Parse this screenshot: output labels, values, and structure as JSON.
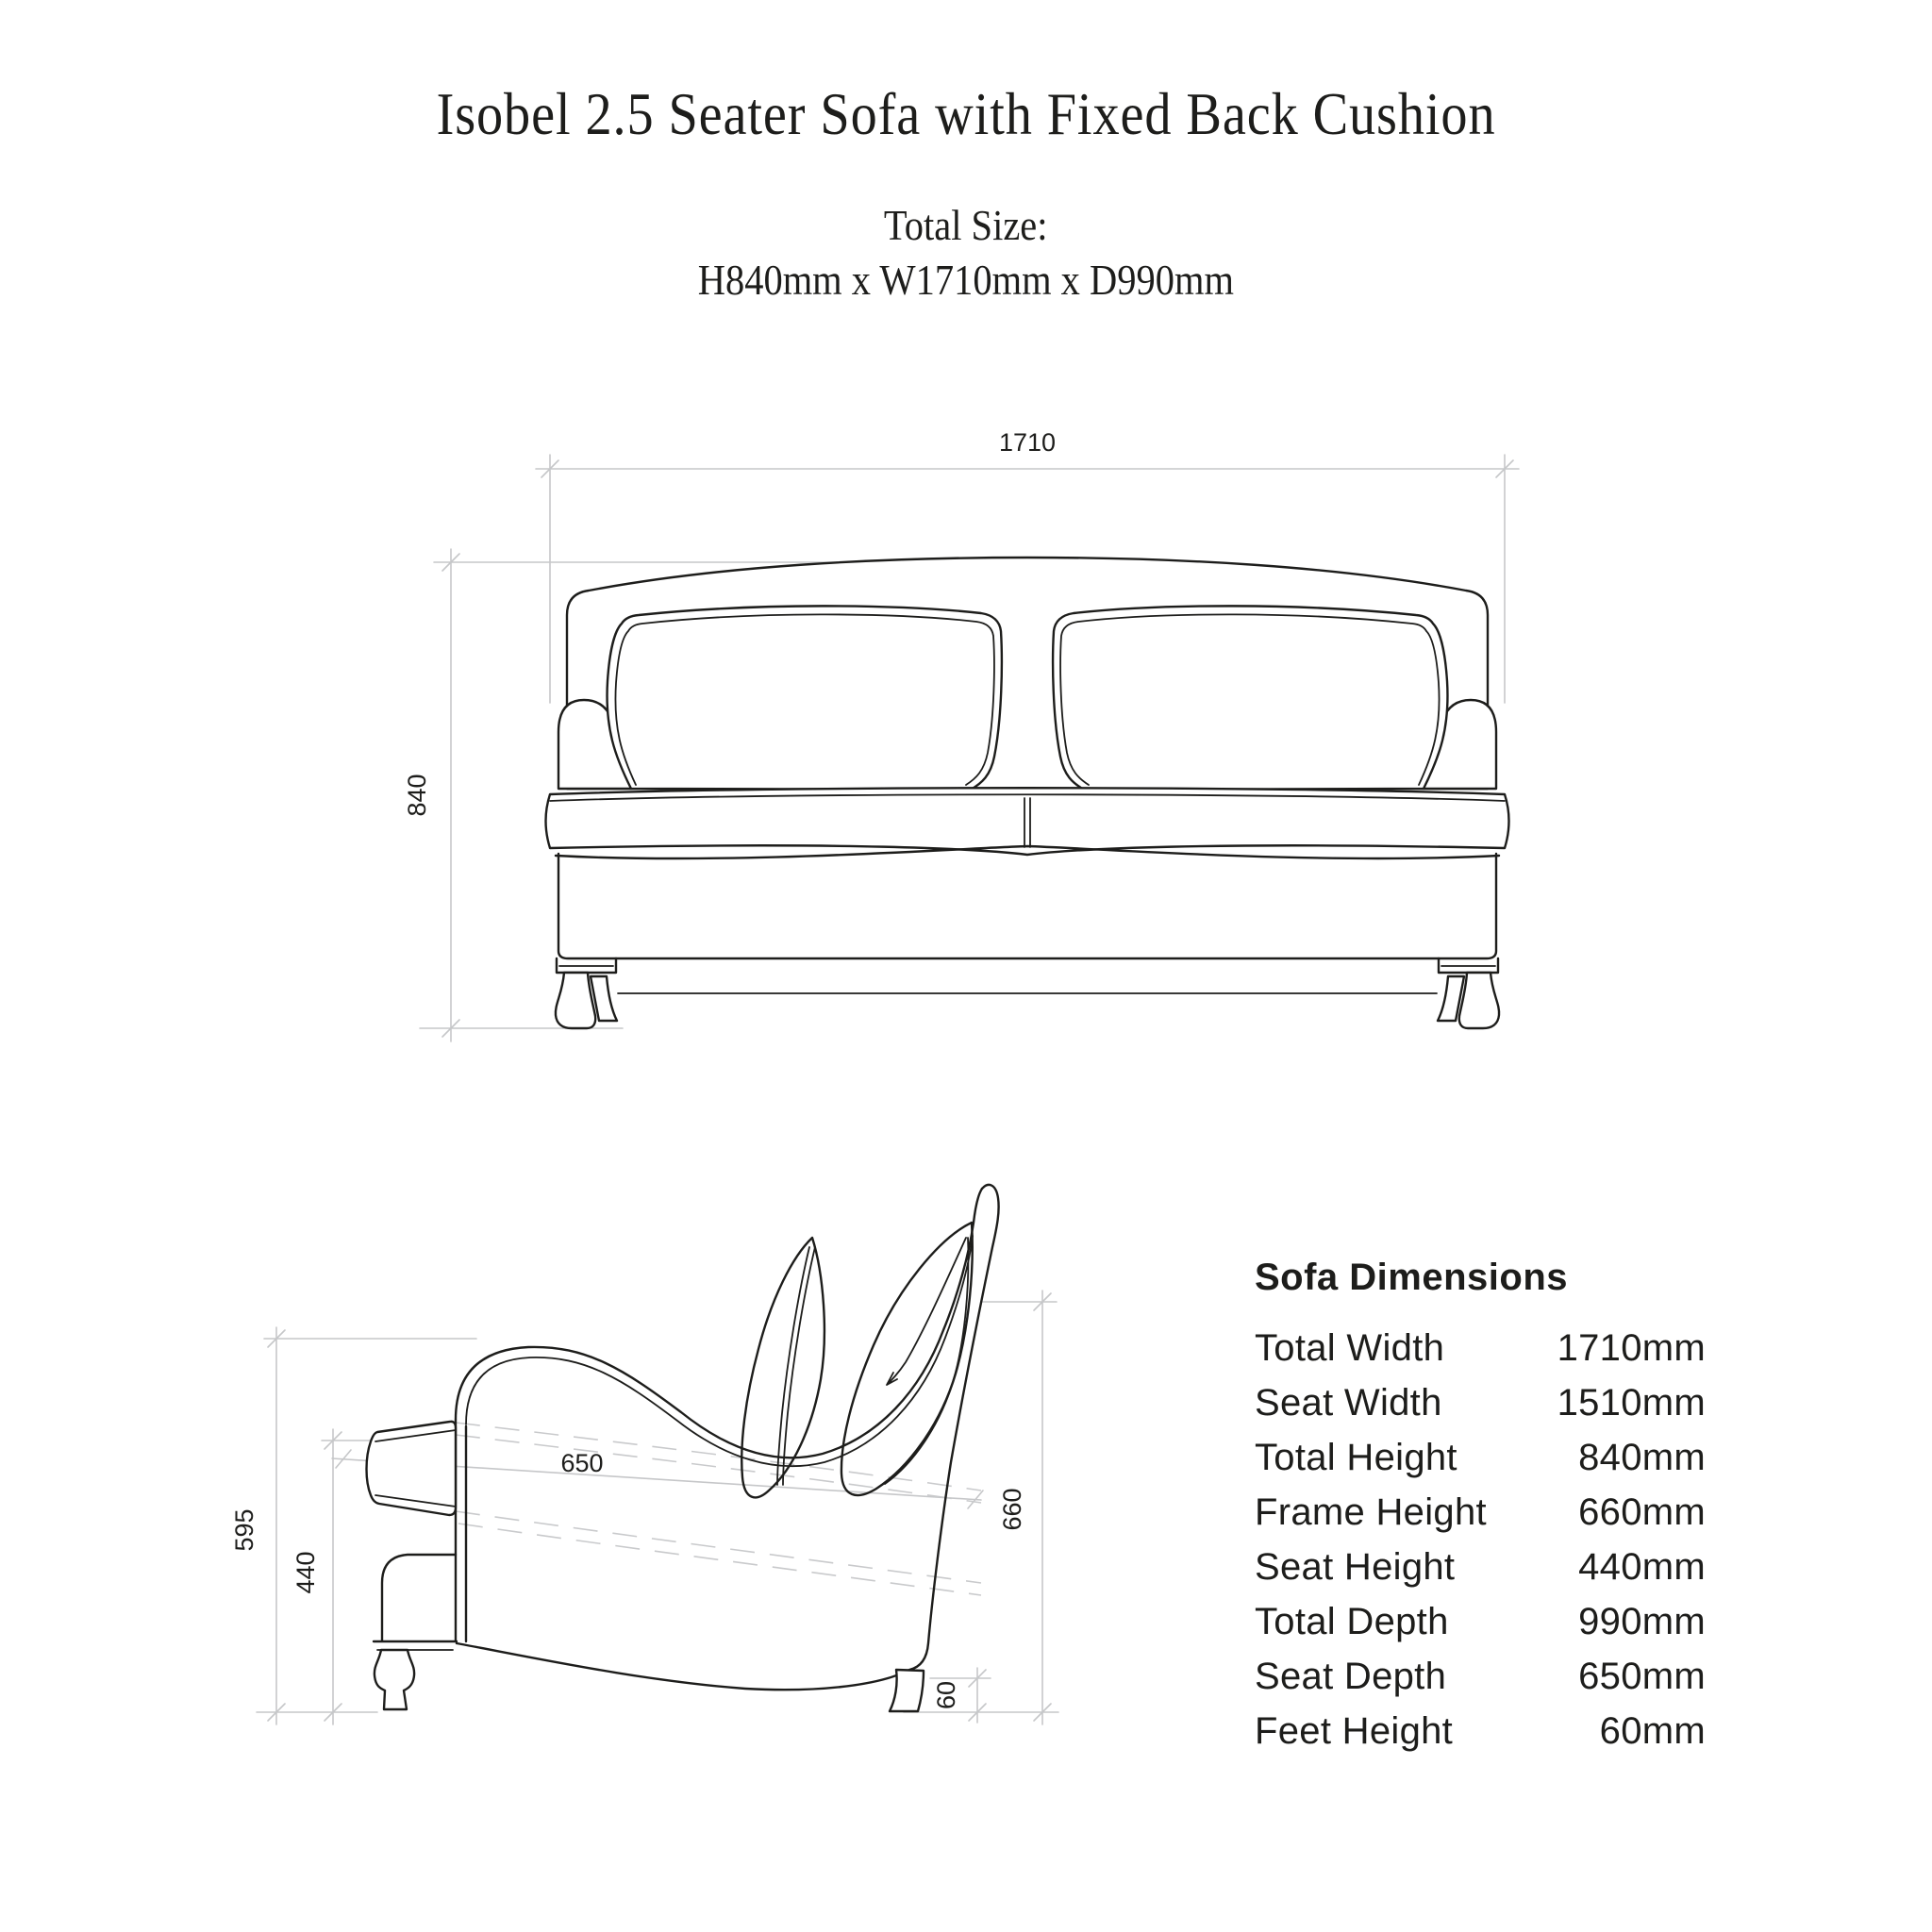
{
  "header": {
    "title": "Isobel 2.5 Seater Sofa with Fixed Back Cushion",
    "total_size_label": "Total Size:",
    "total_size_value": "H840mm x W1710mm x D990mm"
  },
  "front_view": {
    "width_label": "1710",
    "height_label": "840"
  },
  "side_view": {
    "overall_height_label": "595",
    "seat_height_label": "440",
    "seat_depth_label": "650",
    "frame_height_label": "660",
    "feet_height_label": "60"
  },
  "dimensions_table": {
    "title": "Sofa Dimensions",
    "rows": [
      {
        "label": "Total Width",
        "value": "1710mm"
      },
      {
        "label": "Seat Width",
        "value": "1510mm"
      },
      {
        "label": "Total Height",
        "value": "840mm"
      },
      {
        "label": "Frame Height",
        "value": "660mm"
      },
      {
        "label": "Seat Height",
        "value": "440mm"
      },
      {
        "label": "Total Depth",
        "value": "990mm"
      },
      {
        "label": "Seat Depth",
        "value": "650mm"
      },
      {
        "label": "Feet Height",
        "value": "60mm"
      }
    ]
  },
  "colors": {
    "line": "#1d1d1b",
    "dimension_line": "#c6c7c9",
    "background": "#ffffff"
  }
}
